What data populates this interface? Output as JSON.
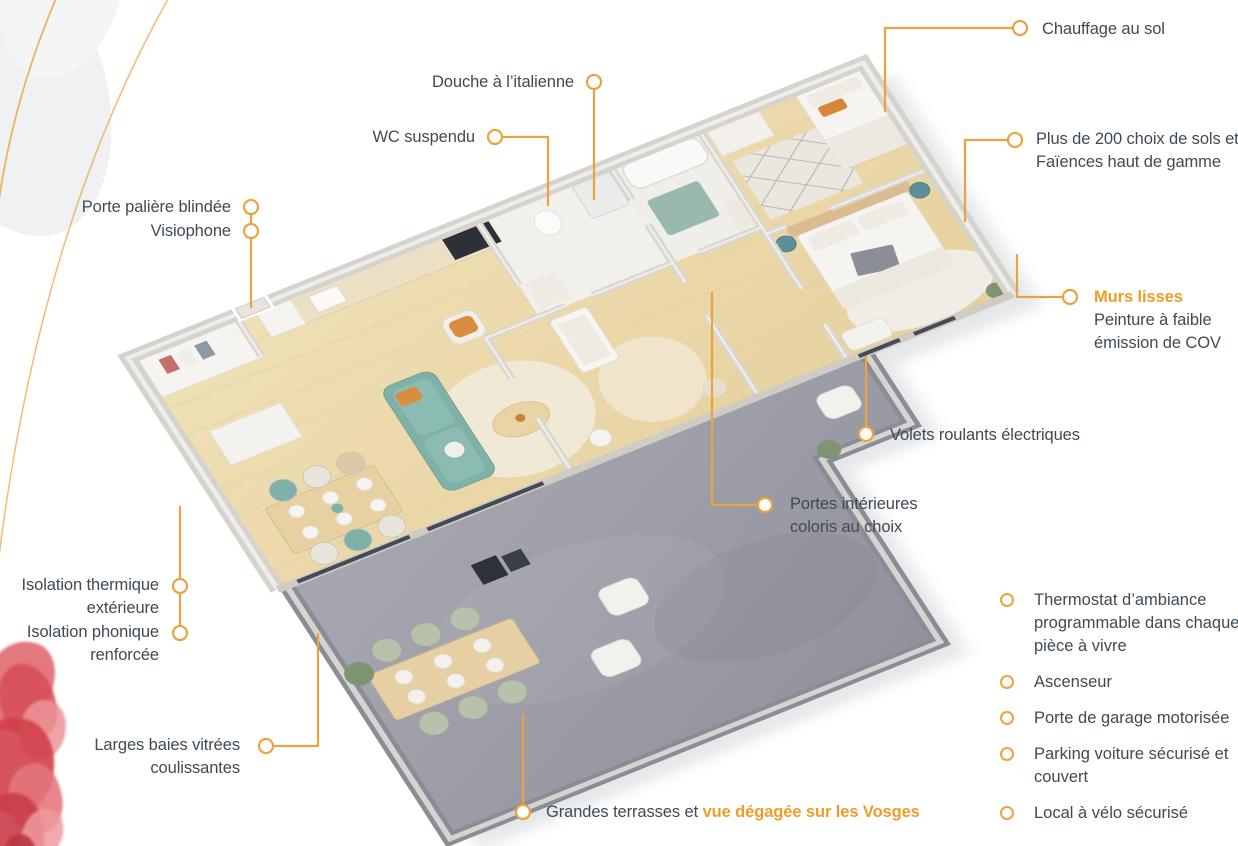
{
  "colors": {
    "accent_line": "#E9A43F",
    "accent_text": "#ED9C28",
    "label_text": "#3E4B55",
    "wood_floor": "#EBD8AB",
    "terrace_floor": "#9C9CA8",
    "sofa_teal": "#7FB1A8"
  },
  "annotations": {
    "chauffage": {
      "label": "Chauffage au sol"
    },
    "douche": {
      "label": "Douche à l’italienne"
    },
    "wc": {
      "label": "WC suspendu"
    },
    "porte_paliere": {
      "label": "Porte palière blindée"
    },
    "visiophone": {
      "label": "Visiophone"
    },
    "sols": {
      "line1": "Plus de 200 choix de sols et",
      "line2": "Faïences haut de gamme"
    },
    "murs": {
      "title": "Murs lisses",
      "line1": "Peinture à faible",
      "line2": "émission de COV"
    },
    "volets": {
      "label": "Volets roulants électriques"
    },
    "portes": {
      "line1": "Portes intérieures",
      "line2": "coloris au choix"
    },
    "isolation_thermique": {
      "line1": "Isolation thermique",
      "line2": "extérieure"
    },
    "isolation_phonique": {
      "line1": "Isolation phonique",
      "line2": "renforcée"
    },
    "baies": {
      "line1": "Larges baies vitrées",
      "line2": "coulissantes"
    },
    "terrasses": {
      "prefix": "Grandes terrasses et ",
      "highlight": "vue dégagée sur les Vosges"
    }
  },
  "features": [
    {
      "label": "Thermostat d’ambiance programmable dans chaque pièce à vivre"
    },
    {
      "label": "Ascenseur"
    },
    {
      "label": "Porte de garage motorisée"
    },
    {
      "label": "Parking voiture sécurisé et couvert"
    },
    {
      "label": "Local à vélo sécurisé"
    }
  ]
}
